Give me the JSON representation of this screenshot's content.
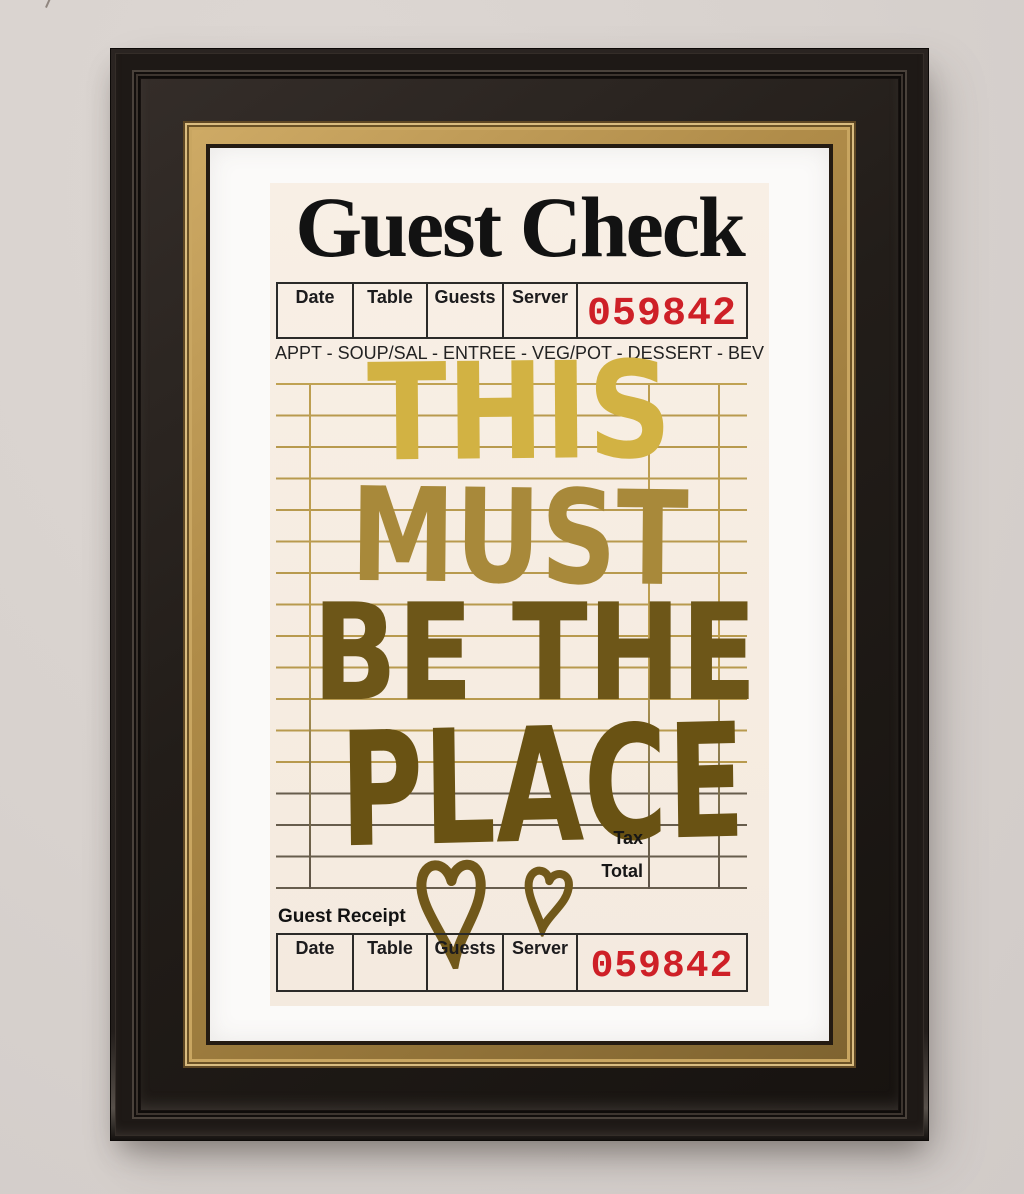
{
  "check": {
    "title": "Guest Check",
    "columns": [
      "Date",
      "Table",
      "Guests",
      "Server"
    ],
    "number": "059842",
    "courses": "APPT - SOUP/SAL - ENTREE - VEG/POT - DESSERT - BEV",
    "message": {
      "line1": "THIS",
      "line2": "MUST",
      "line3": "BE THE",
      "line4": "PLACE"
    },
    "tax_label": "Tax",
    "total_label": "Total",
    "receipt": {
      "heading": "Guest Receipt",
      "columns": [
        "Date",
        "Table",
        "Guests",
        "Server"
      ],
      "number": "059842"
    },
    "colors": {
      "number_red": "#ce2027",
      "foil_light": "#d2b243",
      "foil_mid": "#a8893a",
      "foil_dark": "#695213",
      "grid_line": "#b89a4e",
      "paper": "#f6ece1",
      "frame_black": "#1e1916",
      "frame_gold": "#b08c49",
      "wall": "#d8d2ce"
    }
  }
}
